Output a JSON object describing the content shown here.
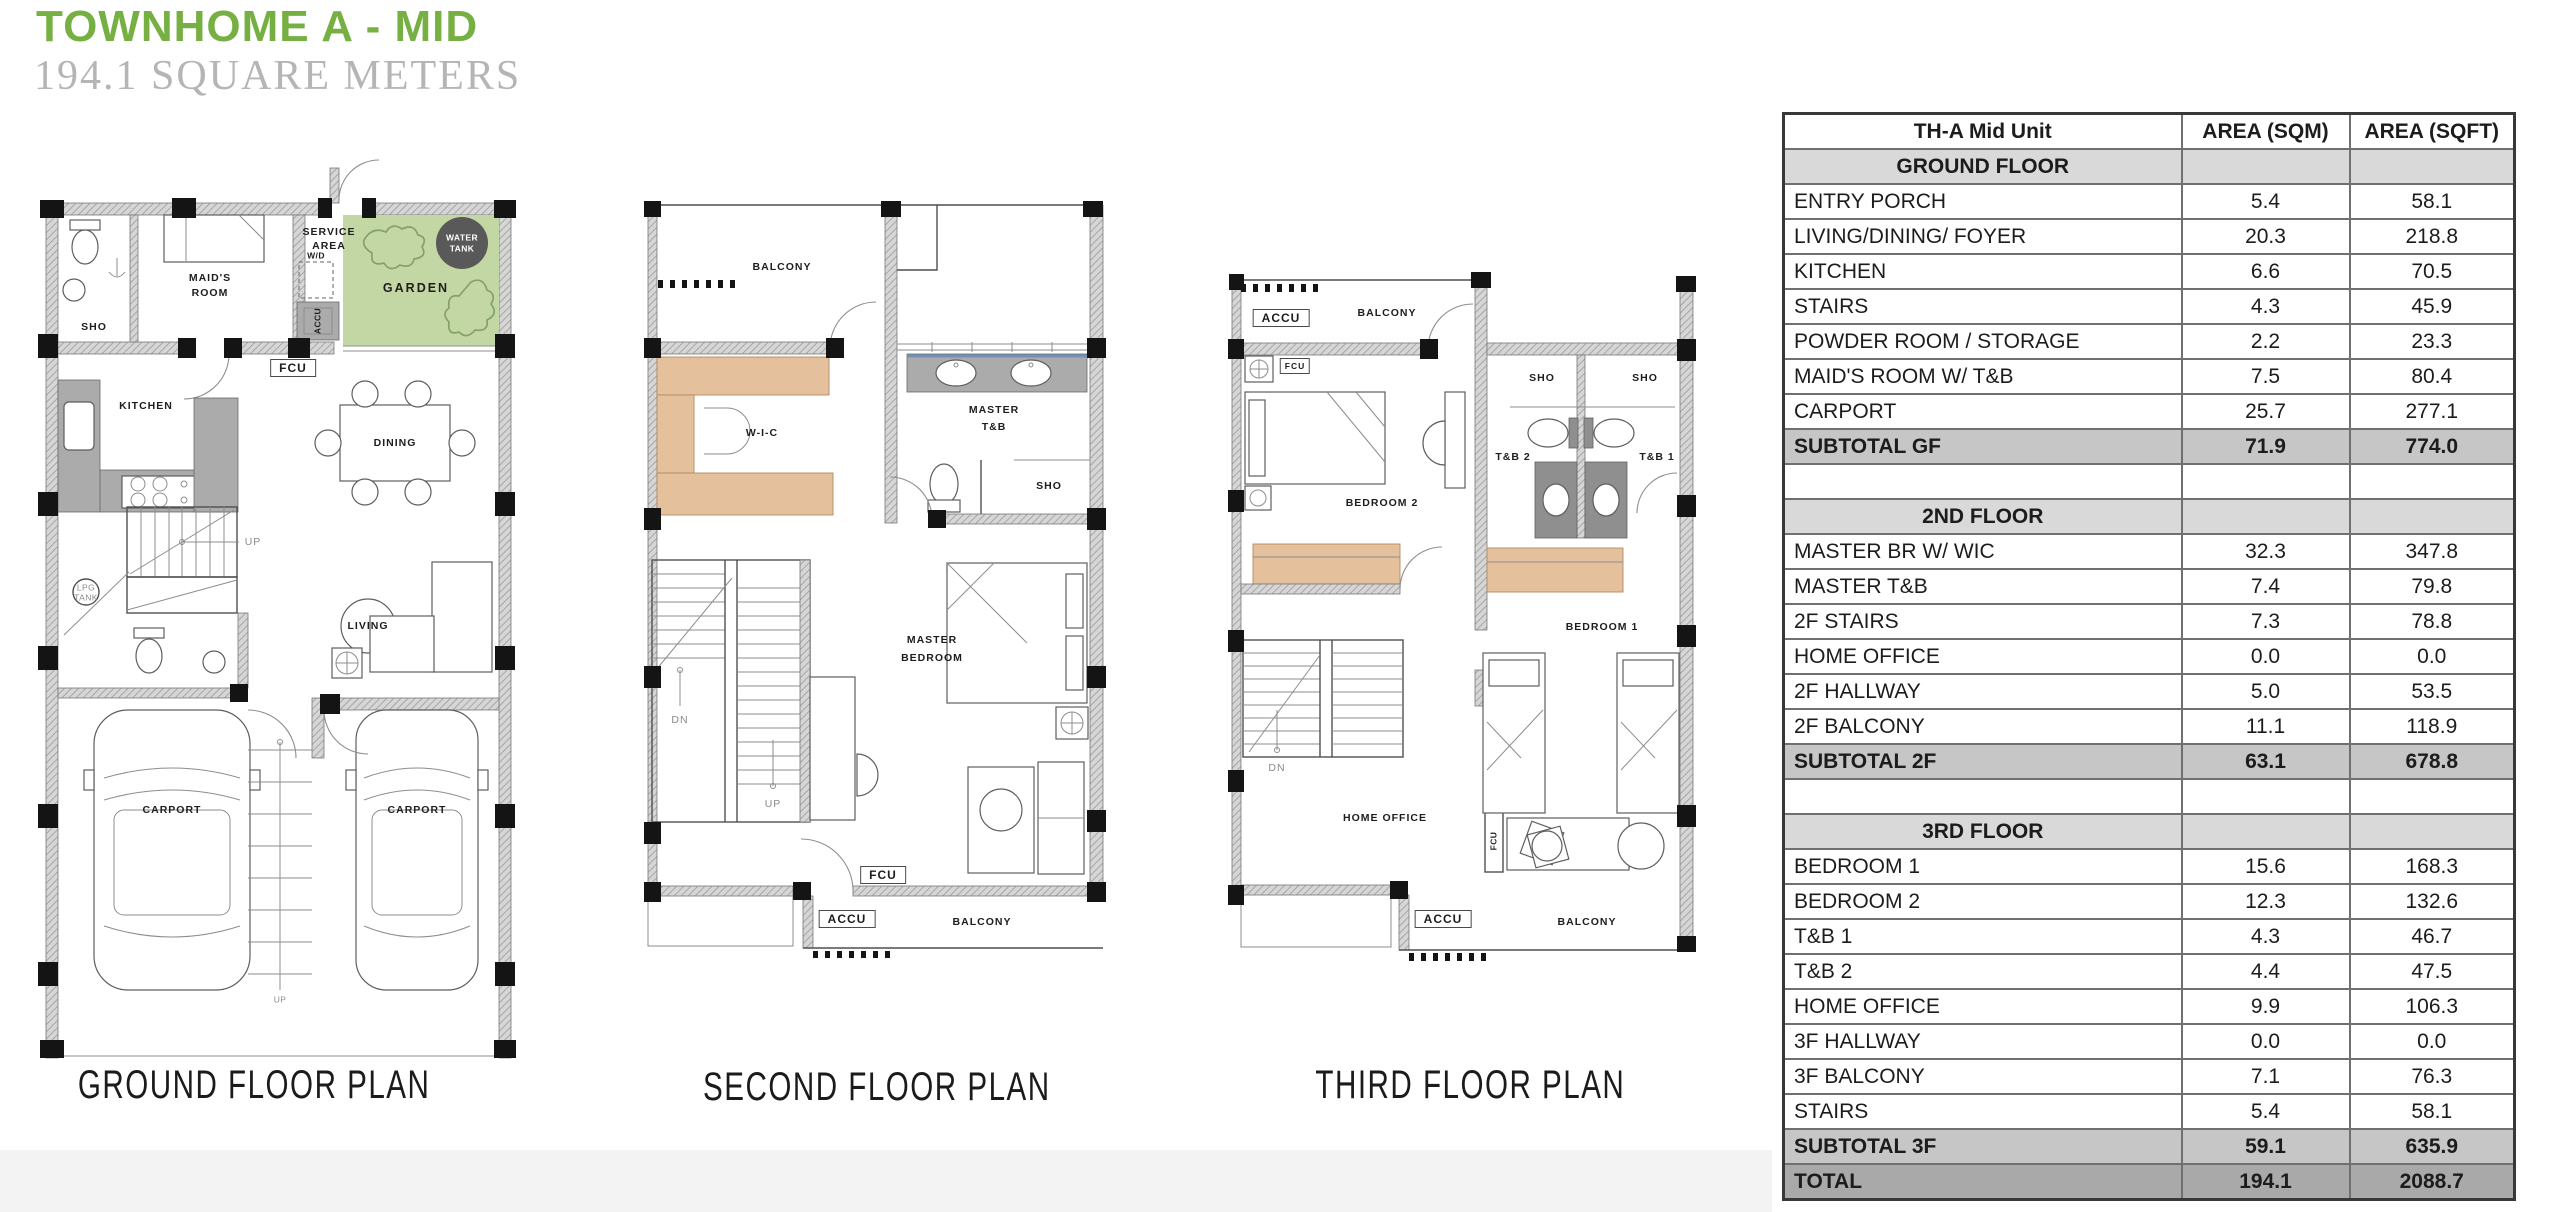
{
  "header": {
    "title": "TOWNHOME A - MID",
    "subtitle": "194.1 SQUARE METERS"
  },
  "colors": {
    "title_green": "#76B043",
    "subtitle_gray": "#B5B5B5",
    "garden_green": "#C3D7A4",
    "water_tank_gray": "#595959",
    "closet_tan": "#E4C19C",
    "section_row_gray": "#D9D9D9",
    "subtotal_row_gray": "#C6C6C6",
    "total_row_gray": "#A9A9A9"
  },
  "plans": {
    "ground": {
      "caption": "GROUND FLOOR PLAN",
      "labels": {
        "sho": "SHO",
        "maids_1": "MAID'S",
        "maids_2": "ROOM",
        "service_1": "SERVICE",
        "service_2": "AREA",
        "wd": "W/D",
        "accu_vert": "ACCU",
        "garden": "GARDEN",
        "water_tank_1": "WATER",
        "water_tank_2": "TANK",
        "fcu": "FCU",
        "kitchen": "KITCHEN",
        "dining": "DINING",
        "living": "LIVING",
        "up_stairs": "UP",
        "lpg_1": "LPG",
        "lpg_2": "TANK",
        "carport_left": "CARPORT",
        "carport_right": "CARPORT",
        "up_entry": "UP"
      }
    },
    "second": {
      "caption": "SECOND FLOOR PLAN",
      "labels": {
        "balcony_top": "BALCONY",
        "wic": "W-I-C",
        "master_tb_1": "MASTER",
        "master_tb_2": "T&B",
        "sho": "SHO",
        "dn": "DN",
        "up": "UP",
        "master_br_1": "MASTER",
        "master_br_2": "BEDROOM",
        "fcu": "FCU",
        "accu": "ACCU",
        "balcony_bottom": "BALCONY"
      }
    },
    "third": {
      "caption": "THIRD FLOOR PLAN",
      "labels": {
        "accu_top": "ACCU",
        "balcony_top": "BALCONY",
        "fcu_top": "FCU",
        "sho_left": "SHO",
        "sho_right": "SHO",
        "tb2": "T&B 2",
        "tb1": "T&B 1",
        "bedroom2": "BEDROOM 2",
        "bedroom1": "BEDROOM 1",
        "dn": "DN",
        "home_office": "HOME OFFICE",
        "fcu_mid": "FCU",
        "accu_bottom": "ACCU",
        "balcony_bottom": "BALCONY"
      }
    }
  },
  "table": {
    "columns": [
      "TH-A Mid Unit",
      "AREA (SQM)",
      "AREA (SQFT)"
    ],
    "rows": [
      {
        "type": "section",
        "label": "GROUND FLOOR",
        "sqm": "",
        "sqft": ""
      },
      {
        "type": "item",
        "label": "ENTRY PORCH",
        "sqm": "5.4",
        "sqft": "58.1"
      },
      {
        "type": "item",
        "label": "LIVING/DINING/ FOYER",
        "sqm": "20.3",
        "sqft": "218.8"
      },
      {
        "type": "item",
        "label": "KITCHEN",
        "sqm": "6.6",
        "sqft": "70.5"
      },
      {
        "type": "item",
        "label": "STAIRS",
        "sqm": "4.3",
        "sqft": "45.9"
      },
      {
        "type": "item",
        "label": "POWDER ROOM / STORAGE",
        "sqm": "2.2",
        "sqft": "23.3"
      },
      {
        "type": "item",
        "label": "MAID'S ROOM W/ T&B",
        "sqm": "7.5",
        "sqft": "80.4"
      },
      {
        "type": "item",
        "label": "CARPORT",
        "sqm": "25.7",
        "sqft": "277.1"
      },
      {
        "type": "subtotal",
        "label": "SUBTOTAL GF",
        "sqm": "71.9",
        "sqft": "774.0"
      },
      {
        "type": "spacer",
        "label": "",
        "sqm": "",
        "sqft": ""
      },
      {
        "type": "section",
        "label": "2ND FLOOR",
        "sqm": "",
        "sqft": ""
      },
      {
        "type": "item",
        "label": "MASTER BR W/ WIC",
        "sqm": "32.3",
        "sqft": "347.8"
      },
      {
        "type": "item",
        "label": "MASTER T&B",
        "sqm": "7.4",
        "sqft": "79.8"
      },
      {
        "type": "item",
        "label": "2F STAIRS",
        "sqm": "7.3",
        "sqft": "78.8"
      },
      {
        "type": "item",
        "label": "HOME OFFICE",
        "sqm": "0.0",
        "sqft": "0.0"
      },
      {
        "type": "item",
        "label": "2F HALLWAY",
        "sqm": "5.0",
        "sqft": "53.5"
      },
      {
        "type": "item",
        "label": "2F BALCONY",
        "sqm": "11.1",
        "sqft": "118.9"
      },
      {
        "type": "subtotal",
        "label": "SUBTOTAL 2F",
        "sqm": "63.1",
        "sqft": "678.8"
      },
      {
        "type": "spacer",
        "label": "",
        "sqm": "",
        "sqft": ""
      },
      {
        "type": "section",
        "label": "3RD FLOOR",
        "sqm": "",
        "sqft": ""
      },
      {
        "type": "item",
        "label": "BEDROOM 1",
        "sqm": "15.6",
        "sqft": "168.3"
      },
      {
        "type": "item",
        "label": "BEDROOM 2",
        "sqm": "12.3",
        "sqft": "132.6"
      },
      {
        "type": "item",
        "label": "T&B 1",
        "sqm": "4.3",
        "sqft": "46.7"
      },
      {
        "type": "item",
        "label": "T&B 2",
        "sqm": "4.4",
        "sqft": "47.5"
      },
      {
        "type": "item",
        "label": "HOME OFFICE",
        "sqm": "9.9",
        "sqft": "106.3"
      },
      {
        "type": "item",
        "label": "3F HALLWAY",
        "sqm": "0.0",
        "sqft": "0.0"
      },
      {
        "type": "item",
        "label": "3F BALCONY",
        "sqm": "7.1",
        "sqft": "76.3"
      },
      {
        "type": "item",
        "label": "STAIRS",
        "sqm": "5.4",
        "sqft": "58.1"
      },
      {
        "type": "subtotal",
        "label": "SUBTOTAL 3F",
        "sqm": "59.1",
        "sqft": "635.9"
      },
      {
        "type": "total",
        "label": "TOTAL",
        "sqm": "194.1",
        "sqft": "2088.7"
      }
    ]
  }
}
